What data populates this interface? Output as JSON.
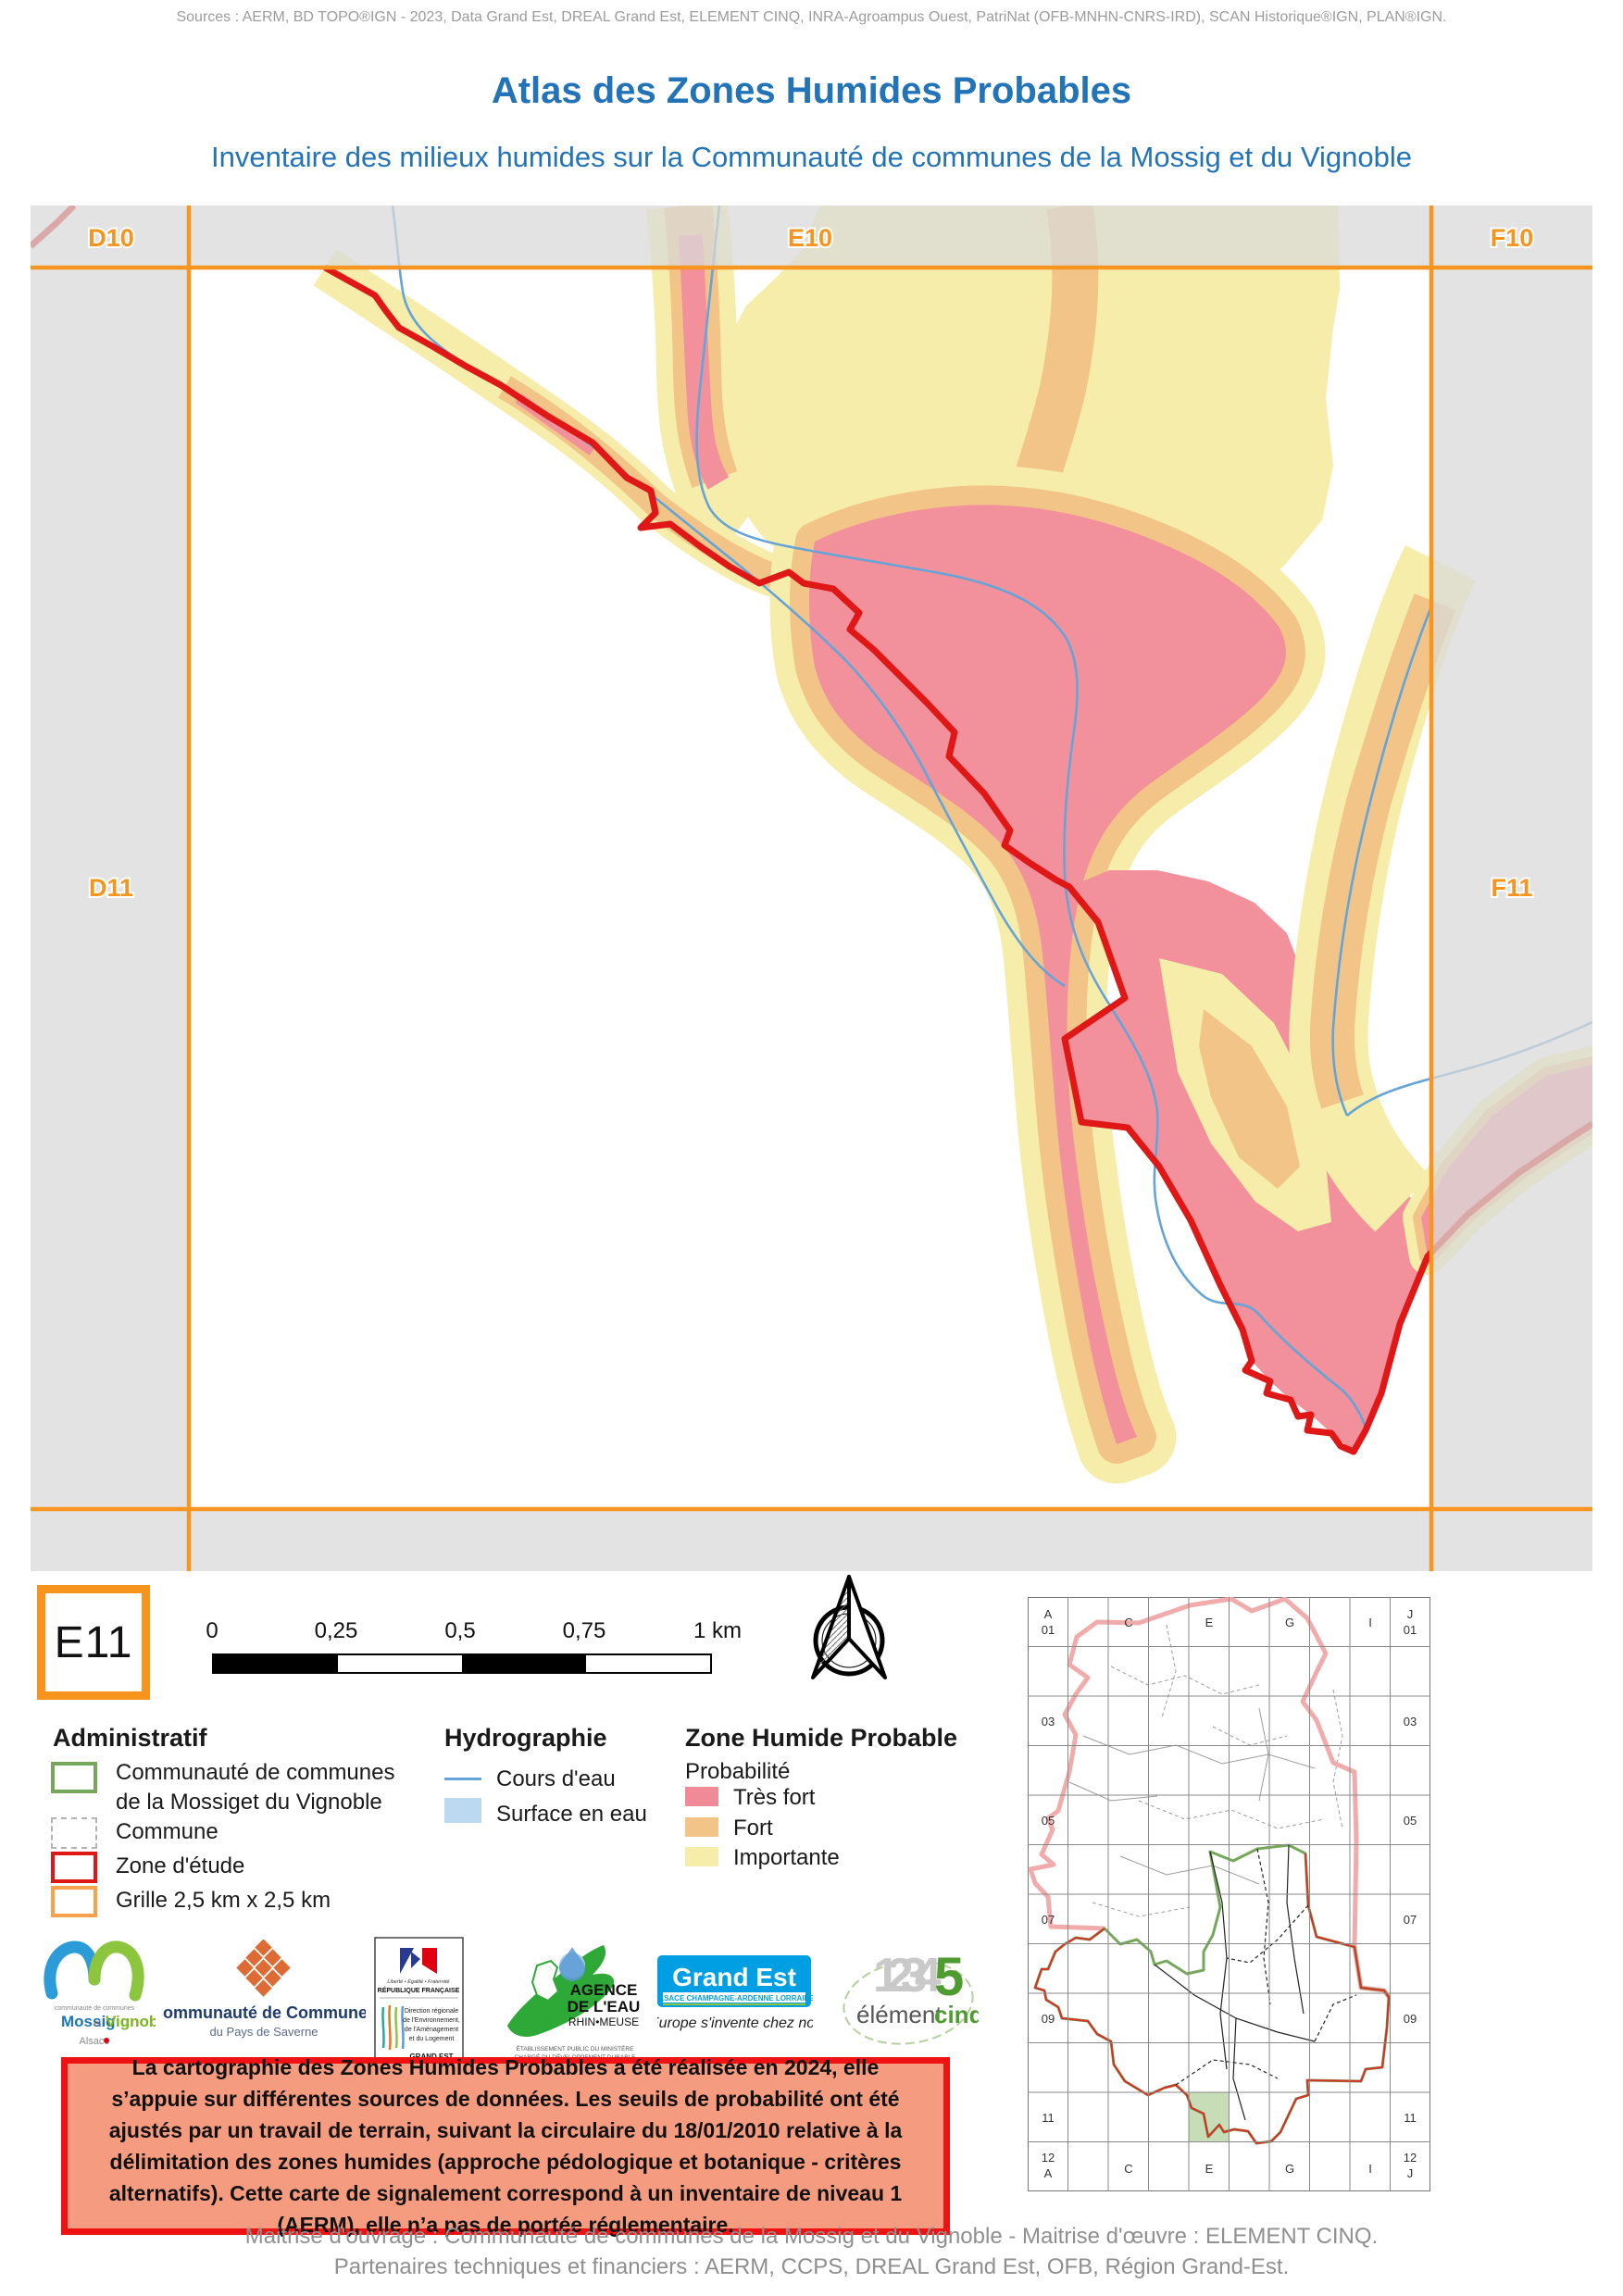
{
  "page": {
    "sources": "Sources : AERM, BD TOPO®IGN - 2023, Data Grand Est, DREAL Grand Est, ELEMENT CINQ, INRA-Agroampus Ouest, PatriNat (OFB-MNHN-CNRS-IRD), SCAN Historique®IGN, PLAN®IGN.",
    "title": "Atlas des Zones Humides Probables",
    "subtitle": "Inventaire des milieux humides sur la Communauté de communes de la Mossig et du Vignoble",
    "footer_line1": "Maitrise d'ouvrage : Communauté de communes de la Mossig et du Vignoble - Maitrise d'œuvre : ELEMENT CINQ.",
    "footer_line2": "Partenaires techniques et financiers : AERM, CCPS, DREAL Grand Est, OFB, Région Grand-Est."
  },
  "map": {
    "tile_label": "E11",
    "labels": {
      "d10": "D10",
      "e10": "E10",
      "f10": "F10",
      "d11": "D11",
      "f11": "F11"
    },
    "colors": {
      "tres_fort": "#F2919B",
      "fort": "#F2C488",
      "importante": "#F6EDAA",
      "cours_eau": "#64A4D8",
      "surface_eau": "#BDD9F2",
      "zone_etude": "#E01717",
      "grille": "#F7941E"
    }
  },
  "scalebar": {
    "t0": "0",
    "t1": "0,25",
    "t2": "0,5",
    "t3": "0,75",
    "t4": "1 km"
  },
  "legend": {
    "administratif": {
      "heading": "Administratif",
      "cc_line1": "Communauté de communes",
      "cc_line2": "de la Mossiget du Vignoble",
      "commune": "Commune",
      "zone_etude": "Zone d'étude",
      "grille": "Grille 2,5 km x 2,5 km"
    },
    "hydrographie": {
      "heading": "Hydrographie",
      "cours_eau": "Cours d'eau",
      "surface_eau": "Surface en eau"
    },
    "zhp": {
      "heading": "Zone Humide Probable",
      "subheading": "Probabilité",
      "tres_fort": "Très fort",
      "fort": "Fort",
      "importante": "Importante"
    }
  },
  "warning": {
    "text": "La cartographie des Zones Humides Probables a été réalisée en 2024, elle s’appuie sur différentes sources de données. Les seuils de probabilité ont été ajustés par un travail de terrain, suivant la circulaire du 18/01/2010 relative à la délimitation des zones humides (approche pédologique et botanique - critères alternatifs). Cette carte de signalement correspond à un inventaire de niveau 1 (AERM), elle n’a pas de portée réglementaire."
  },
  "logos": {
    "mossig": {
      "top": "communauté de communes",
      "name1": "Mossig",
      "conj": "et",
      "name2": "Vignoble",
      "region": "Alsace"
    },
    "saverne": {
      "title": "Communauté de Communes",
      "subtitle": "du Pays de Saverne"
    },
    "dreal": {
      "motto": "Liberté • Égalité • Fraternité",
      "republic": "RÉPUBLIQUE FRANÇAISE",
      "l1": "Direction régionale",
      "l2": "de l'Environnement,",
      "l3": "de l'Aménagement",
      "l4": "et du Logement",
      "footer": "GRAND EST"
    },
    "agence_eau": {
      "l1": "AGENCE",
      "l2": "DE L'EAU",
      "l3": "RHIN•MEUSE",
      "tag1": "ÉTABLISSEMENT PUBLIC DU MINISTÈRE",
      "tag2": "CHARGÉ DU DÉVELOPPEMENT DURABLE"
    },
    "grand_est": {
      "brand": "Grand Est",
      "banner": "ALSACE CHAMPAGNE-ARDENNE LORRAINE",
      "tagline": "L'Europe s'invente chez nous"
    },
    "element5": {
      "digits": "1234",
      "five": "5",
      "word1": "élément",
      "word2": "cinq"
    }
  },
  "overview": {
    "top_labels": [
      "A",
      "01",
      "C",
      "E",
      "G",
      "I",
      "J",
      "01"
    ],
    "left_labels": [
      "03",
      "05",
      "07",
      "09",
      "11"
    ],
    "right_labels": [
      "03",
      "05",
      "07",
      "09",
      "11"
    ],
    "bottom_labels": [
      "12",
      "A",
      "C",
      "E",
      "G",
      "I",
      "12",
      "J"
    ]
  }
}
